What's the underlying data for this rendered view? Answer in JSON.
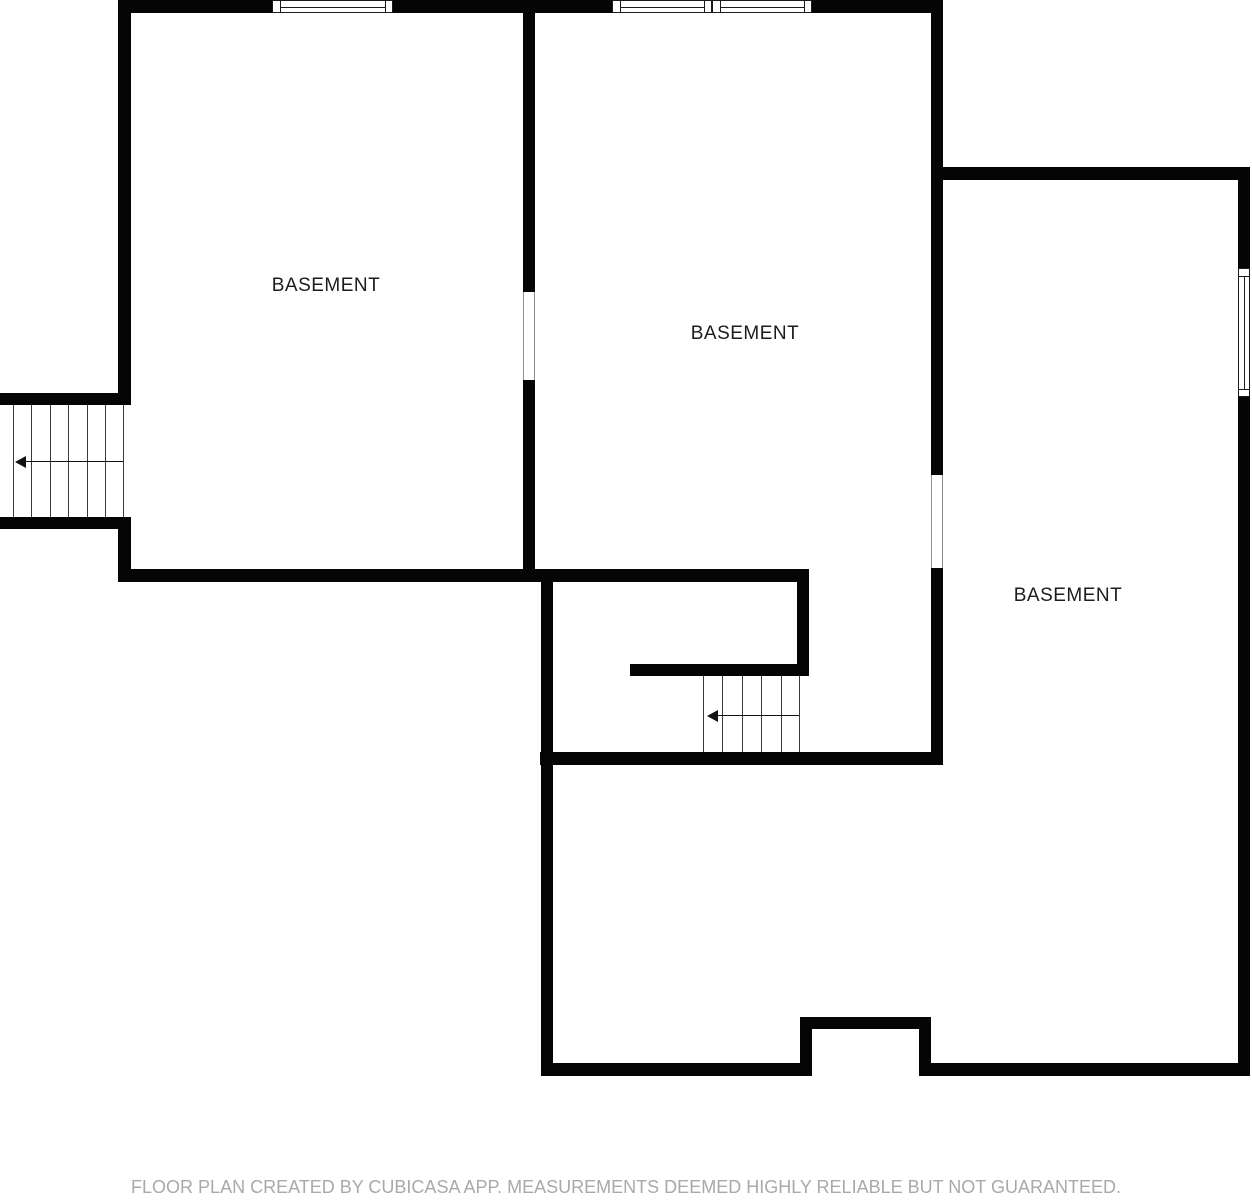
{
  "canvas": {
    "width": 1252,
    "height": 1200,
    "background_color": "#ffffff",
    "wall_color": "#050505",
    "label_color": "#1c1c1c",
    "footer_color": "#a9a9a9"
  },
  "rooms": [
    {
      "label": "BASEMENT",
      "cx": 326,
      "cy": 286
    },
    {
      "label": "BASEMENT",
      "cx": 745,
      "cy": 334
    },
    {
      "label": "BASEMENT",
      "cx": 1068,
      "cy": 596
    }
  ],
  "footer": {
    "text": "FLOOR PLAN CREATED BY CUBICASA APP. MEASUREMENTS DEEMED HIGHLY RELIABLE BUT NOT GUARANTEED."
  },
  "walls": [
    {
      "x": 118,
      "y": 0,
      "w": 825,
      "h": 13
    },
    {
      "x": 118,
      "y": 0,
      "w": 13,
      "h": 405
    },
    {
      "x": 118,
      "y": 517,
      "w": 13,
      "h": 65
    },
    {
      "x": 0,
      "y": 393,
      "w": 131,
      "h": 12
    },
    {
      "x": 0,
      "y": 517,
      "w": 131,
      "h": 12
    },
    {
      "x": 523,
      "y": 0,
      "w": 12,
      "h": 292
    },
    {
      "x": 523,
      "y": 380,
      "w": 12,
      "h": 195
    },
    {
      "x": 118,
      "y": 569,
      "w": 691,
      "h": 13
    },
    {
      "x": 541,
      "y": 569,
      "w": 12,
      "h": 507
    },
    {
      "x": 797,
      "y": 569,
      "w": 12,
      "h": 107
    },
    {
      "x": 630,
      "y": 664,
      "w": 179,
      "h": 12
    },
    {
      "x": 931,
      "y": 0,
      "w": 12,
      "h": 475
    },
    {
      "x": 931,
      "y": 568,
      "w": 12,
      "h": 197
    },
    {
      "x": 540,
      "y": 752,
      "w": 403,
      "h": 13
    },
    {
      "x": 931,
      "y": 167,
      "w": 319,
      "h": 13
    },
    {
      "x": 1238,
      "y": 167,
      "w": 12,
      "h": 101
    },
    {
      "x": 1238,
      "y": 397,
      "w": 12,
      "h": 679
    },
    {
      "x": 541,
      "y": 1063,
      "w": 271,
      "h": 13
    },
    {
      "x": 800,
      "y": 1017,
      "w": 12,
      "h": 59
    },
    {
      "x": 800,
      "y": 1017,
      "w": 131,
      "h": 12
    },
    {
      "x": 919,
      "y": 1017,
      "w": 12,
      "h": 59
    },
    {
      "x": 919,
      "y": 1063,
      "w": 331,
      "h": 13
    }
  ],
  "windows": [
    {
      "x": 272,
      "y": 0,
      "w": 121,
      "h": 13,
      "orientation": "h"
    },
    {
      "x": 612,
      "y": 0,
      "w": 100,
      "h": 13,
      "orientation": "h"
    },
    {
      "x": 712,
      "y": 0,
      "w": 100,
      "h": 13,
      "orientation": "h"
    },
    {
      "x": 1238,
      "y": 268,
      "w": 12,
      "h": 129,
      "orientation": "v"
    }
  ],
  "door_openings": [
    {
      "x": 523,
      "y": 292,
      "w": 12,
      "h": 88,
      "orientation": "v"
    },
    {
      "x": 931,
      "y": 475,
      "w": 12,
      "h": 93,
      "orientation": "v"
    }
  ],
  "staircases": [
    {
      "name": "staircase-left-exterior",
      "x": 0,
      "y": 405,
      "w": 125,
      "h": 112,
      "treads": [
        13,
        31,
        50,
        68,
        87,
        105,
        123
      ],
      "arrow": {
        "y": 56,
        "tip_x": 15,
        "tail_x": 123,
        "direction": "left"
      }
    },
    {
      "name": "staircase-interior",
      "x": 703,
      "y": 676,
      "w": 97,
      "h": 76,
      "treads": [
        0,
        19,
        39,
        58,
        78,
        96
      ],
      "arrow": {
        "y": 39,
        "tip_x": 4,
        "tail_x": 96,
        "direction": "left"
      }
    }
  ]
}
